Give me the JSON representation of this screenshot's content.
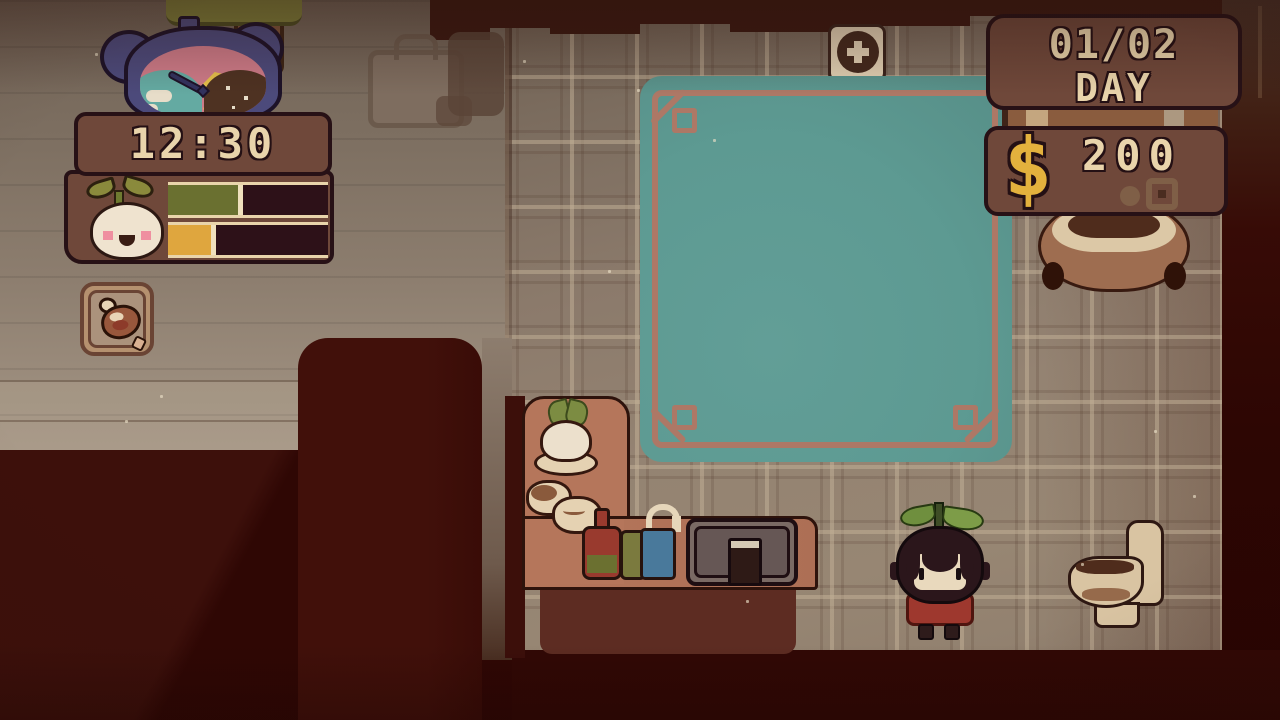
{
  "title": "pixel life-sim bathhouse scene",
  "hud": {
    "clock_time": "12:30",
    "day_panel": {
      "value": "01/02",
      "label": "DAY"
    },
    "money_panel": {
      "symbol": "$",
      "amount": "200"
    },
    "status_panel": {
      "avatar": "turnip-buddy",
      "bars": [
        {
          "name": "growth",
          "fill_color": "#6a7030",
          "fill_percent": 47,
          "fill_style": "width:47%;background:#6a7030"
        },
        {
          "name": "energy",
          "fill_color": "#dfa63e",
          "fill_percent": 30,
          "fill_style": "width:30%;background:#dfa63e"
        }
      ]
    },
    "hotbar_slot": {
      "item": "drumstick"
    }
  },
  "scene": {
    "wall_sign": "plus-cross plaque",
    "objects": {
      "bear_alarm_clock": "day-night bear clock",
      "tree": "tree behind clock",
      "picture": "faded briefcase on wall",
      "pool": "teal bath pool with copper trim",
      "planter": "round clay pot",
      "counter": "washroom counter with turnip dish, bowls, bottles, soap and sink",
      "player": "sprout-haired kid in red shirt",
      "toilet": "toilet facing left"
    },
    "colors": {
      "pool": "#5d9a92",
      "pool_border": "#ad7866",
      "panel": "#6f483a",
      "panel_border": "#271116",
      "text_cream": "#e9d4ab",
      "money_yellow": "#e3b13d",
      "floor": "#8f7e6f",
      "void_maroon": "#330905",
      "counter_top": "#b5765b"
    }
  }
}
